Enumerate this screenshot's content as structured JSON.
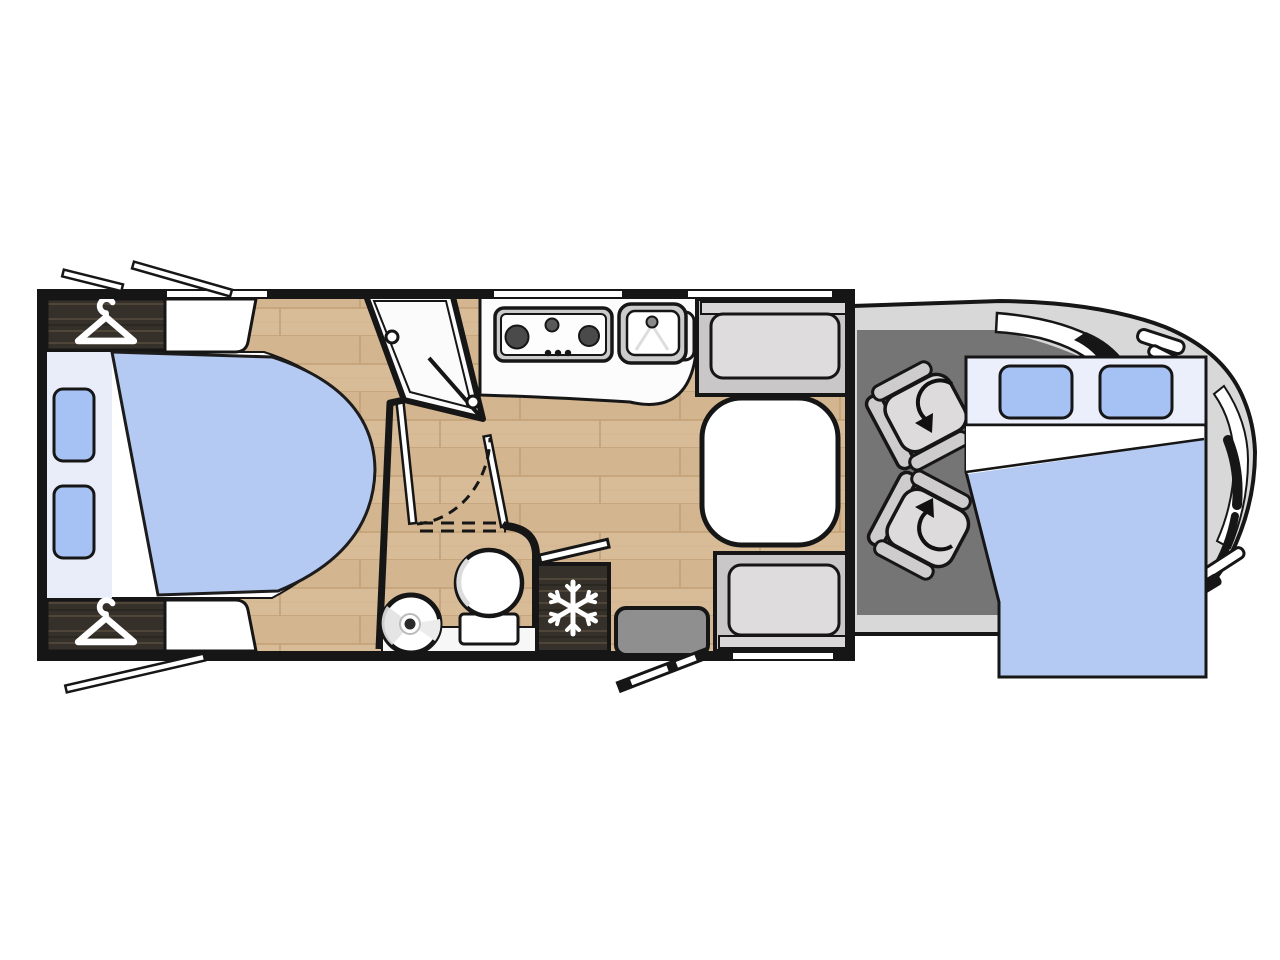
{
  "page": {
    "type": "motorhome-floorplan-diagram",
    "background": "#ffffff"
  },
  "colors": {
    "wall": "#161616",
    "outline": "#161616",
    "floor_wood": "#d8bc98",
    "floor_wood_alt": "#d3b690",
    "floor_wood_line": "#c2a077",
    "dark_wood": "#35302a",
    "dark_wood_streak": "#55493c",
    "bed_blue": "#b5caf3",
    "pillow_blue": "#a6c2f4",
    "bed_pale_band": "#eaeffb",
    "pillow_panel": "#e9edf9",
    "sheet_white": "#ffffff",
    "cab_floor": "#757575",
    "body_gray": "#d8d8d8",
    "bench_gray": "#c9c7c8",
    "bench_inner": "#dedcdd",
    "bench_band": "#d9d7d8",
    "seat_gray": "#cecccd",
    "seat_cushion": "#dddbdc",
    "table_white": "#ffffff",
    "step_gray": "#8f8f8f",
    "burner_dark": "#4a4a4a",
    "counter_white": "#fcfcfc",
    "shower_white": "#fbfbfb",
    "fixture_white": "#ffffff",
    "appliance_gray": "#cbcbcb",
    "faucet_gray": "#8a8a8a",
    "spray_gray": "#dddddd",
    "vanity_white": "#f7f7f7",
    "basin_shade": "#e2e2e2"
  },
  "floorplan": {
    "vehicle": "coachbuilt motorhome, cab at right, habitation box at left",
    "rooms": [
      {
        "id": "rear-bedroom",
        "features": [
          "island-double-bed",
          "pillow-left",
          "pillow-right",
          "wardrobe-top",
          "wardrobe-bottom",
          "headboard-window-top",
          "headboard-window-bottom"
        ]
      },
      {
        "id": "washroom",
        "features": [
          "corner-shower-cubicle",
          "toilet",
          "round-basin",
          "vanity-counter",
          "folding-partition-doors",
          "door-swing-arc"
        ]
      },
      {
        "id": "kitchen",
        "features": [
          "three-burner-hob",
          "kitchen-sink",
          "worktop",
          "fridge-freezer"
        ]
      },
      {
        "id": "dinette",
        "features": [
          "bench-seat-front",
          "bench-seat-rear",
          "pedestal-table"
        ]
      },
      {
        "id": "cab",
        "features": [
          "driver-swivel-seat",
          "passenger-swivel-seat",
          "drop-down-bed",
          "windscreen",
          "side-windows",
          "entry-step"
        ]
      }
    ],
    "openings": [
      "open-window-bar-rear-top-short",
      "open-window-bar-rear-top-long",
      "open-window-bar-rear-bottom",
      "entry-door-open-bar",
      "fridge-vent-flap-bar"
    ]
  },
  "icons": [
    {
      "name": "hanger-icon",
      "meaning": "wardrobe / clothes storage",
      "count": 2
    },
    {
      "name": "snowflake-icon",
      "meaning": "fridge-freezer",
      "count": 1
    },
    {
      "name": "swivel-arrow-icon",
      "meaning": "rotating cab seat",
      "count": 2
    }
  ]
}
